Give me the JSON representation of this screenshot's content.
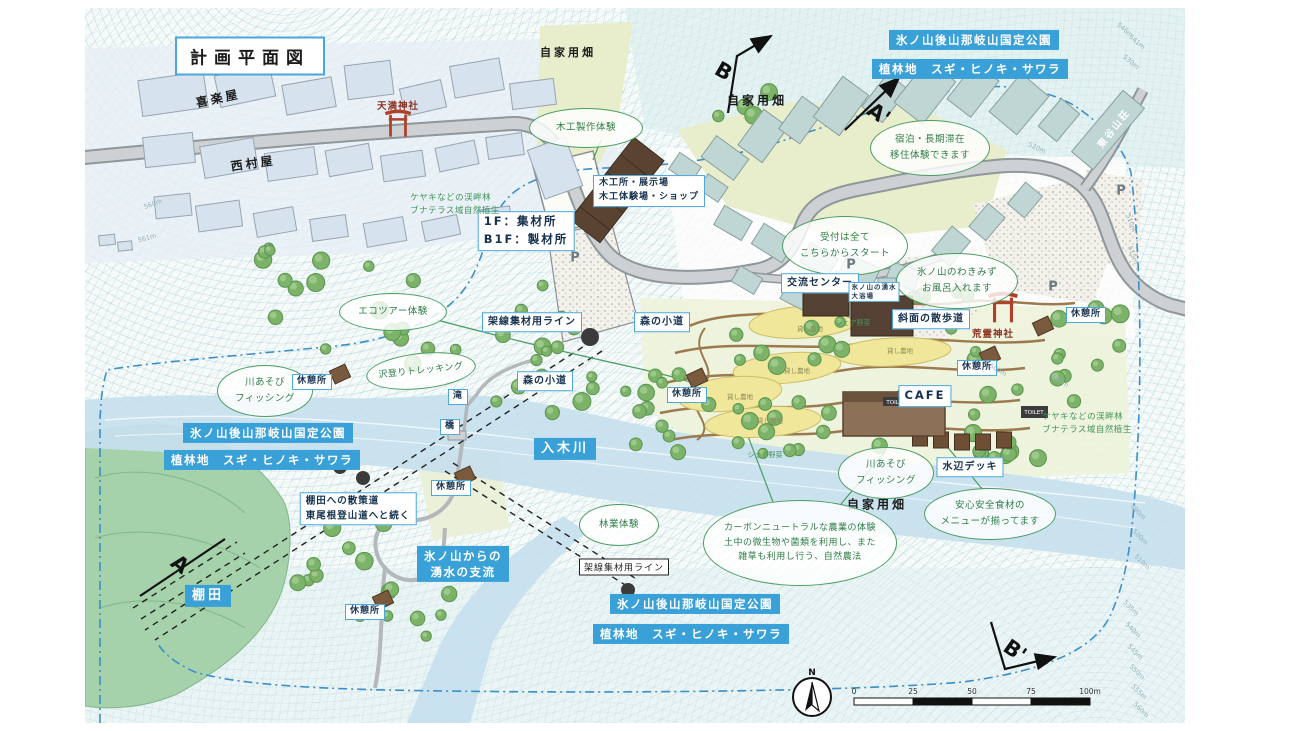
{
  "colors": {
    "banner_blue": "#3aa0d8",
    "box_border": "#4aa7d9",
    "bubble_green": "#4a9d62",
    "torii_red": "#b0402a"
  },
  "title": "計画平面図",
  "banners": {
    "park": "氷ノ山後山那岐山国定公園",
    "plantation": "植林地　スギ・ヒノキ・サワラ",
    "river": "入木川",
    "tributary_line1": "氷ノ山からの",
    "tributary_line2": "湧水の支流",
    "terrace": "棚田"
  },
  "places": {
    "kirakuya": "喜楽屋",
    "nishimuraya": "西村屋",
    "tenma_shrine": "天満神社",
    "arei_shrine": "荒霊神社",
    "higashidani_lodge": "東谷山荘",
    "home_garden": "自家用畑",
    "exchange_center": "交流センター",
    "hot_spring_line1": "氷ノ山の湧水",
    "hot_spring_line2": "大浴場",
    "cafe": "CAFE",
    "toilet": "TOILET",
    "parking": "P"
  },
  "boxes": {
    "woodshop_line1": "木工所・展示場",
    "woodshop_line2": "木工体験場・ショップ",
    "lumber_line1": "1F：集材所",
    "lumber_line2": "B1F：製材所",
    "slope_walk": "斜面の散歩道",
    "cable_line": "架線集材用ライン",
    "forest_path": "森の小道",
    "waterfall": "滝",
    "bridge": "橋",
    "rest_area": "休憩所",
    "terrace_walk_line1": "棚田への散策道",
    "terrace_walk_line2": "東尾根登山道へと続く",
    "waterside_deck": "水辺デッキ"
  },
  "bubbles": {
    "woodcraft": "木工製作体験",
    "stay_line1": "宿泊・長期滞在",
    "stay_line2": "移住体験できます",
    "reception_line1": "受付は全て",
    "reception_line2": "こちらからスタート",
    "bath_line1": "氷ノ山のわきみず",
    "bath_line2": "お風呂入れます",
    "ecotour": "エコツアー体験",
    "trekking": "沢登りトレッキング",
    "river_play_line1": "川あそび",
    "river_play_line2": "フィッシング",
    "forestry": "林業体験",
    "agri_line1": "カーボンニュートラルな農業の体験",
    "agri_line2": "土中の微生物や菌類を利用し、また",
    "agri_line3": "雑草も利用し行う、自然農法",
    "menu_line1": "安心安全食材の",
    "menu_line2": "メニューが揃ってます"
  },
  "notes": {
    "keyaki_line1": "ケヤキなどの渓畔林",
    "keyaki_line2": "ブナテラス域自然植生",
    "share_field": "シェア野菜",
    "rental_field": "貸し農地"
  },
  "sections": {
    "a": "A",
    "a2": "A'",
    "b": "B",
    "b2": "B'"
  },
  "compass": {
    "n": "N"
  },
  "scale_bar": {
    "ticks": [
      "0",
      "25",
      "50",
      "75",
      "100m"
    ]
  },
  "markers": {
    "rest_areas": [
      [
        227,
        374
      ],
      [
        366,
        480
      ],
      [
        280,
        604
      ],
      [
        602,
        387
      ],
      [
        892,
        360
      ],
      [
        1001,
        307
      ]
    ],
    "p_marks": [
      [
        490,
        250
      ],
      [
        766,
        257
      ],
      [
        968,
        279
      ],
      [
        1036,
        183
      ]
    ],
    "rental_patches": [
      [
        725,
        320
      ],
      [
        815,
        342
      ],
      [
        712,
        362
      ],
      [
        655,
        388
      ],
      [
        685,
        412
      ]
    ],
    "share_fields": [
      [
        768,
        315
      ],
      [
        680,
        447
      ]
    ],
    "contours": [
      [
        "546m",
        1040,
        22,
        40
      ],
      [
        "541m",
        1052,
        34,
        40
      ],
      [
        "530m",
        1046,
        54,
        40
      ],
      [
        "520m",
        952,
        140,
        25
      ],
      [
        "510m",
        1046,
        215,
        70
      ],
      [
        "515m",
        1048,
        247,
        70
      ],
      [
        "500m",
        913,
        362,
        30
      ],
      [
        "490m",
        975,
        373,
        30
      ],
      [
        "490m",
        1053,
        504,
        45
      ],
      [
        "500m",
        1055,
        529,
        45
      ],
      [
        "510m",
        1057,
        554,
        45
      ],
      [
        "535m",
        1046,
        600,
        45
      ],
      [
        "540m",
        1048,
        622,
        45
      ],
      [
        "545m",
        1050,
        644,
        45
      ],
      [
        "550m",
        1052,
        664,
        45
      ],
      [
        "555m",
        1054,
        684,
        45
      ],
      [
        "560m",
        1056,
        702,
        45
      ],
      [
        "560m",
        68,
        196,
        -20
      ],
      [
        "561m",
        62,
        230,
        -15
      ]
    ]
  }
}
